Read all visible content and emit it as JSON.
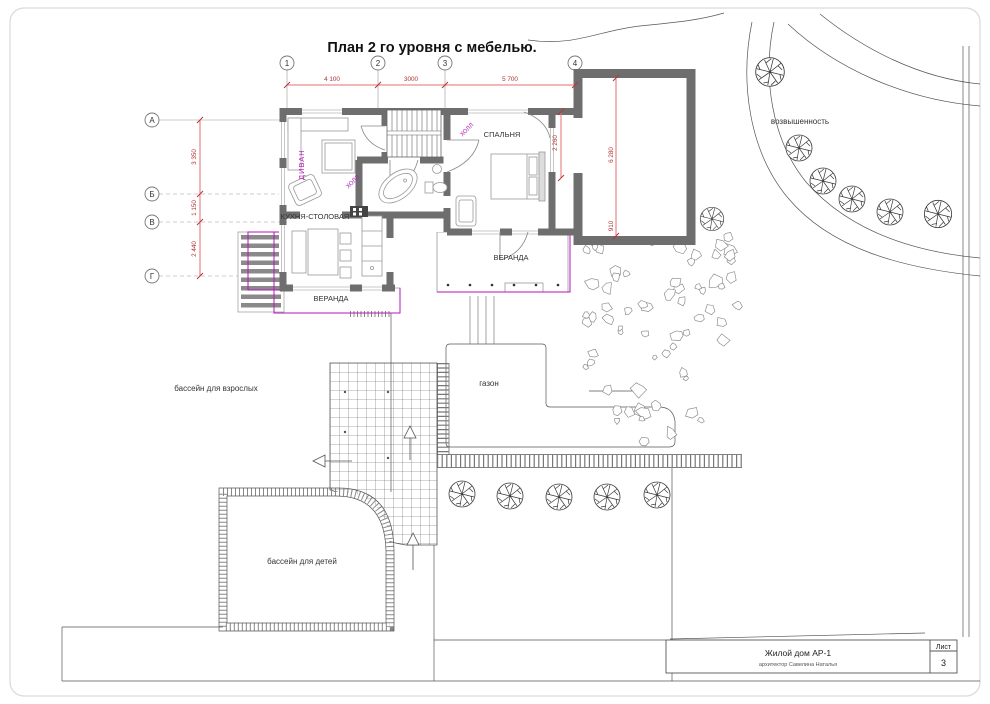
{
  "drawing": {
    "title": "План 2 го уровня с мебелью."
  },
  "axes": {
    "cols": [
      "1",
      "2",
      "3",
      "4"
    ],
    "rows": [
      "А",
      "Б",
      "В",
      "Г"
    ]
  },
  "dims": {
    "c12": "4 100",
    "c23": "3000",
    "c34": "5 700",
    "rAB": "3 350",
    "rBV": "1 150",
    "rVG": "2 440",
    "garage": "6 280",
    "garage_w": "910",
    "bedroom": "2 260"
  },
  "rooms": {
    "divan": "ДИВАН",
    "kitchen": "КУХНЯ-СТОЛОВАЯ",
    "bedroom": "СПАЛЬНЯ",
    "veranda1": "ВЕРАНДА",
    "veranda2": "ВЕРАНДА",
    "hall1": "ХОЛЛ",
    "hall2": "ХОЛЛ"
  },
  "site": {
    "hill": "возвышенность",
    "adult_pool": "бассейн для взрослых",
    "lawn": "газон",
    "kids_pool": "бассейн для детей"
  },
  "title_block": {
    "project": "Жилой дом АР-1",
    "architect": "архитектор Савелина Наталья",
    "sheet_label": "Лист",
    "sheet_number": "3"
  },
  "colors": {
    "wall": "#6e6e6e",
    "dim_line": "#e07070",
    "dim_text": "#b03030",
    "magenta": "#b516b5",
    "line": "#555555"
  }
}
